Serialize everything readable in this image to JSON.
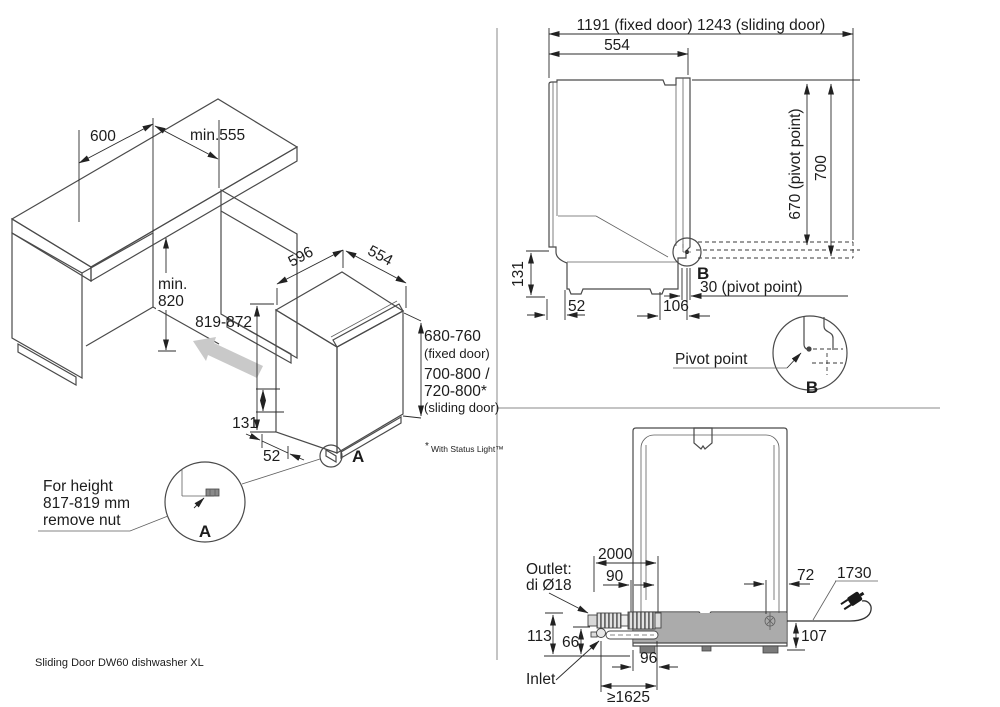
{
  "caption": "Sliding Door DW60 dishwasher XL",
  "colors": {
    "top_gray": "#9d9d9d",
    "side_gray": "#8f8f8f",
    "door_gray": "#aaaaaa",
    "band_gray": "#c9c9c9",
    "kick_gray": "#d9d9d9",
    "profile_gray": "#b3b3b3",
    "arrow_gray": "#c9c9c9"
  },
  "niche": {
    "width": "600",
    "depth": "min.555",
    "height_l1": "min.",
    "height_l2": "820"
  },
  "dw": {
    "width": "596",
    "depth": "554",
    "height_range": "819-872",
    "plinth_height": "131",
    "plinth_depth": "52",
    "fixed_height": "680-760",
    "fixed_note": "(fixed door)",
    "sliding_height_1": "700-800 /",
    "sliding_height_2": "720-800*",
    "sliding_note": "(sliding door)",
    "footnote_star": "*",
    "footnote": "With Status Light™",
    "detail": "A",
    "note_l1": "For height",
    "note_l2": "817-819 mm",
    "note_l3": "remove nut"
  },
  "side": {
    "total_depth": "1191 (fixed door) 1243 (sliding door)",
    "body_depth": "554",
    "pivot_height": "670 (pivot point)",
    "door_height": "700",
    "plinth_height": "131",
    "rear_inset": "52",
    "pivot_depth": "106",
    "pivot_inset": "30 (pivot point)",
    "detail": "B",
    "detail_b": "B",
    "pivot_label": "Pivot point"
  },
  "rear": {
    "drain_length": "2000",
    "drain_side": "90",
    "cord_side": "72",
    "cord_length": "1730",
    "cord_height": "107",
    "outlet_l1": "Outlet:",
    "outlet_l2": "di Ø18",
    "outlet_height": "113",
    "inlet_height": "66",
    "inlet_side": "96",
    "inlet_min": "≥1625",
    "inlet_label": "Inlet"
  }
}
